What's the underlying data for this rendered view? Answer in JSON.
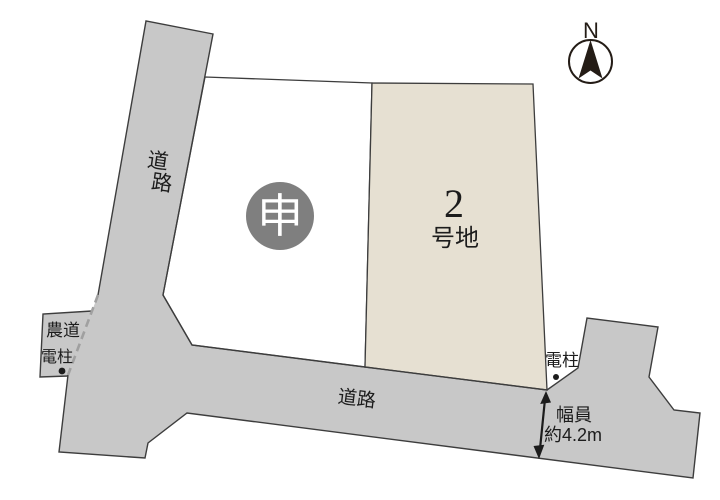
{
  "compass": {
    "label": "N"
  },
  "roads": {
    "left_vertical": {
      "char_top": "道",
      "char_bottom": "路"
    },
    "bottom": {
      "label": "道路"
    },
    "farm_road": {
      "label": "農道"
    }
  },
  "lots": {
    "lot1": {
      "badge": "申"
    },
    "lot2": {
      "number": "2",
      "suffix": "号地"
    }
  },
  "poles": {
    "left": {
      "label": "電柱"
    },
    "right": {
      "label": "電柱"
    }
  },
  "width_note": {
    "line1": "幅員",
    "line2": "約4.2m"
  },
  "colors": {
    "road_fill": "#c8c8c8",
    "lot1_fill": "#ffffff",
    "lot2_fill": "#e6e0d2",
    "badge_fill": "#7f7f7f",
    "badge_text": "#ffffff",
    "outline": "#3d3d3d",
    "dash": "#a0a0a0",
    "text": "#1c1c1c",
    "compass": "#241c16"
  }
}
